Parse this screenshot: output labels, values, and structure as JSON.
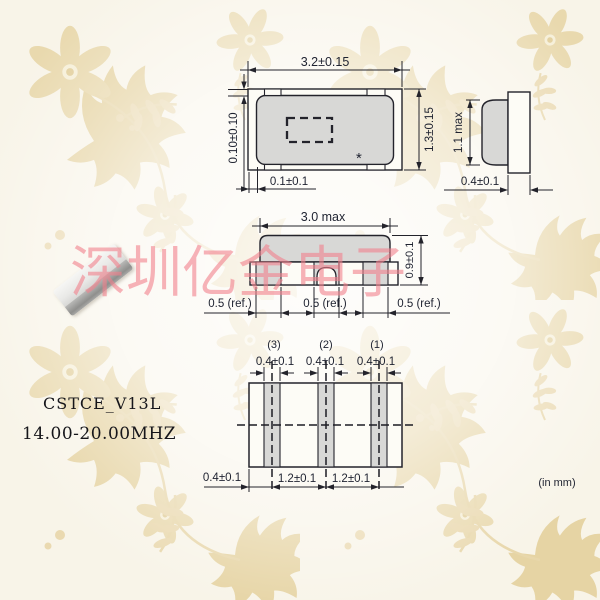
{
  "watermark": {
    "text": "深圳亿金电子"
  },
  "product": {
    "model": "CSTCE_V13L",
    "frequency": "14.00-20.00MHZ"
  },
  "note_units": "(in mm)",
  "top_view": {
    "width": "3.2±0.15",
    "height": "1.3±0.15",
    "offset_top": "0.10±0.10",
    "offset_bottom": "0.1±0.1",
    "polarity_mark": "*"
  },
  "side_view": {
    "height": "1.1 max",
    "terminal_width": "0.4±0.1"
  },
  "front_view": {
    "width": "3.0 max",
    "height": "0.9±0.1",
    "pad_left": "0.5 (ref.)",
    "pad_center": "0.5 (ref.)",
    "pad_right": "0.5 (ref.)"
  },
  "land_pattern": {
    "pin3": "(3)",
    "pin2": "(2)",
    "pin1": "(1)",
    "pad3_width": "0.4±0.1",
    "pad2_width": "0.4±0.1",
    "pad1_width": "0.4±0.1",
    "edge_to_center": "0.4±0.1",
    "pitch_left": "1.2±0.1",
    "pitch_right": "1.2±0.1"
  }
}
